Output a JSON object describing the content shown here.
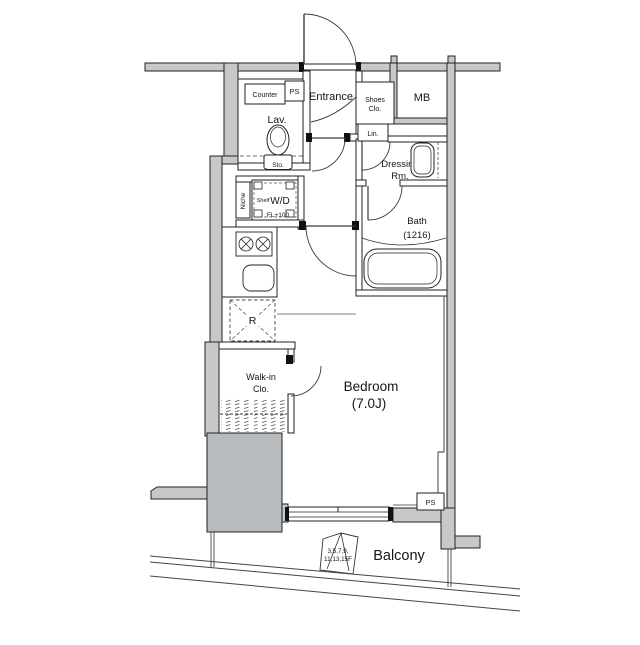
{
  "plan": {
    "type": "apartment-floor-plan",
    "colors": {
      "wall_gray": "#c6c8ca",
      "pillar_gray": "#b8bbbd",
      "line": "#222222",
      "background": "#ffffff"
    },
    "labels": {
      "counter": "Counter",
      "ps_upper": "PS",
      "entrance": "Entrance",
      "shoes_closet_line1": "Shoes",
      "shoes_closet_line2": "Clo.",
      "meter_box": "MB",
      "lavatory": "Lav.",
      "storage": "Sto.",
      "linen": "Lin.",
      "dressing_line1": "Dressing",
      "dressing_line2": "Rm.",
      "bath_line1": "Bath",
      "bath_line2": "(1216)",
      "niche": "Niche",
      "shelf": "Shelf",
      "washer_dryer": "W/D",
      "floor_level": "FL+100",
      "refrigerator": "R",
      "walkin_line1": "Walk-in",
      "walkin_line2": "Clo.",
      "bedroom_line1": "Bedroom",
      "bedroom_line2": "(7.0J)",
      "balcony": "Balcony",
      "floors_line1": "3,5,7,9,",
      "floors_line2": "11,13,15F",
      "ps_lower": "PS"
    }
  }
}
